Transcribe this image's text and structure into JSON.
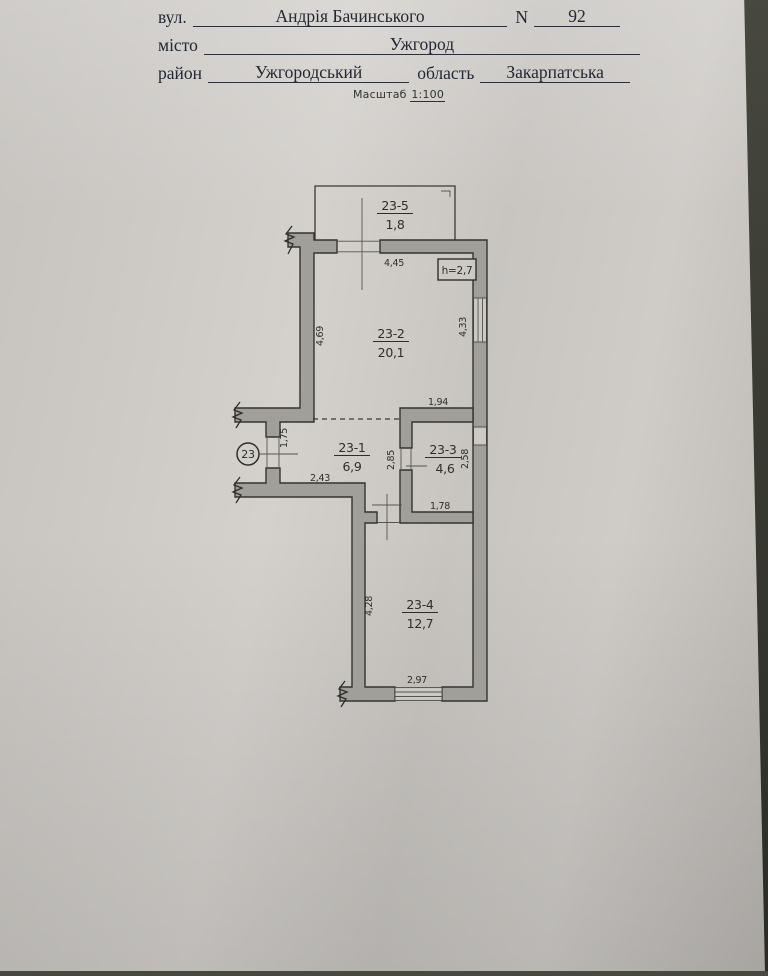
{
  "header": {
    "street_label": "вул.",
    "street_value": "Андрія Бачинського",
    "number_label": "N",
    "number_value": "92",
    "city_label": "місто",
    "city_value": "Ужгород",
    "district_label": "район",
    "district_value": "Ужгородський",
    "oblast_label": "область",
    "oblast_value": "Закарпатська",
    "scale_label": "Масштаб",
    "scale_value": "1:100"
  },
  "plan": {
    "apartment_number": "23",
    "height_note": "h=2,7",
    "rooms": [
      {
        "id": "23-1",
        "area": "6,9"
      },
      {
        "id": "23-2",
        "area": "20,1"
      },
      {
        "id": "23-3",
        "area": "4,6"
      },
      {
        "id": "23-4",
        "area": "12,7"
      },
      {
        "id": "23-5",
        "area": "1,8"
      }
    ],
    "dims": {
      "room2_width": "4,45",
      "room2_left": "4,69",
      "room2_right": "4,33",
      "room3_top": "1,94",
      "entry_door": "1,75",
      "hall_width": "2,43",
      "room3_door": "2,85",
      "room3_right": "2,58",
      "room3_width": "1,78",
      "room4_height": "4,28",
      "room4_width": "2,97"
    }
  }
}
